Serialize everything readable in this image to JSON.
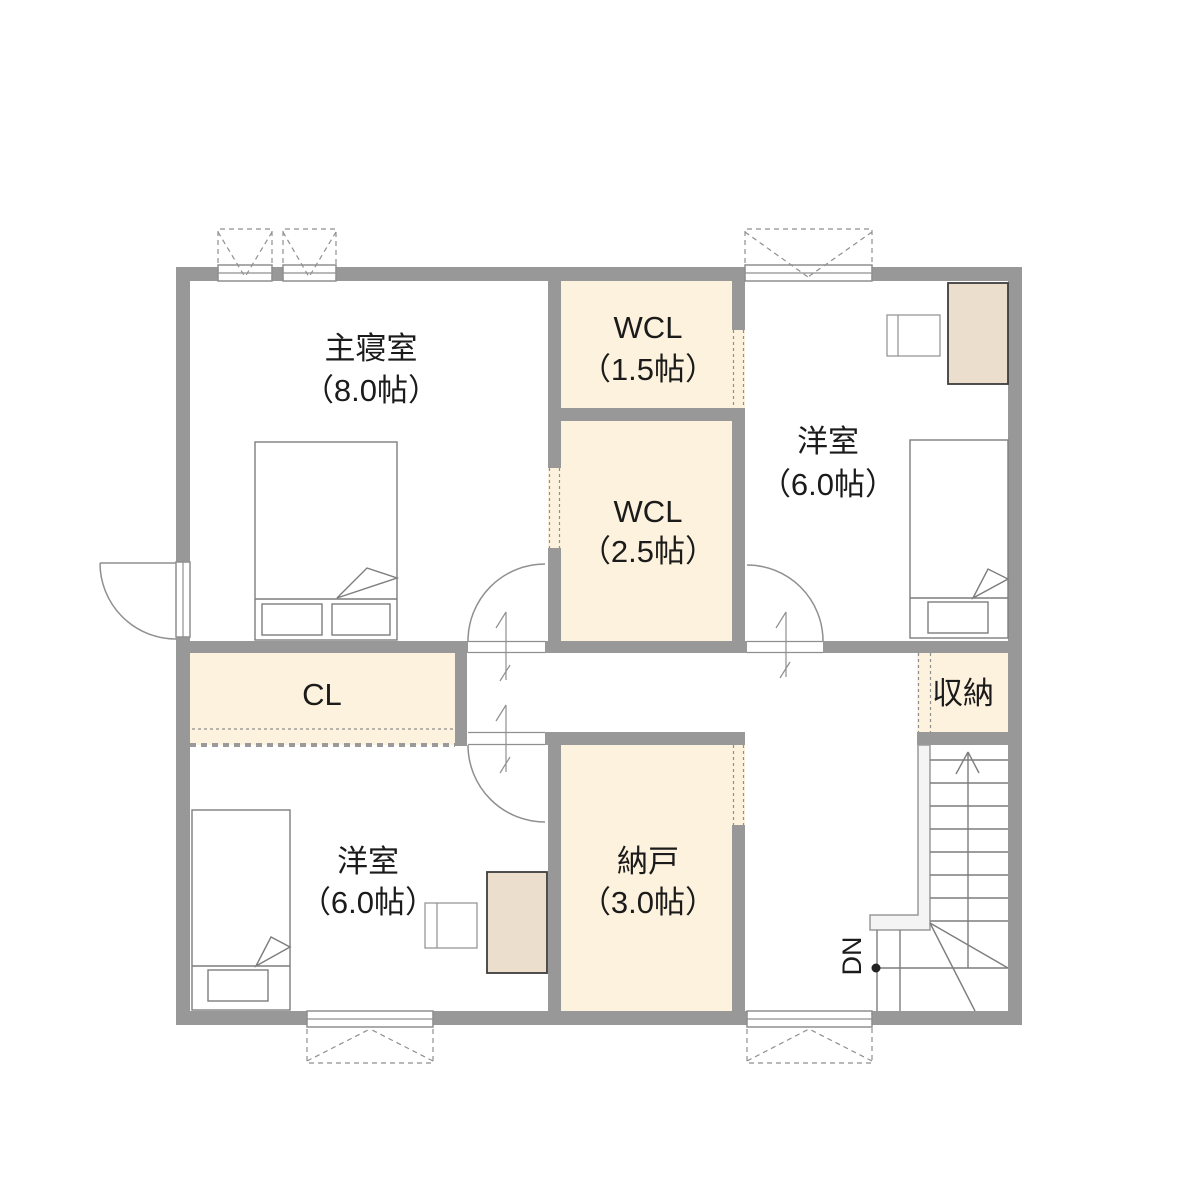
{
  "rooms": {
    "master_bedroom": {
      "name": "主寝室",
      "size": "（8.0帖）"
    },
    "wcl_small": {
      "name": "WCL",
      "size": "（1.5帖）"
    },
    "wcl_large": {
      "name": "WCL",
      "size": "（2.5帖）"
    },
    "bedroom_east": {
      "name": "洋室",
      "size": "（6.0帖）"
    },
    "closet": {
      "name": "CL"
    },
    "storage_shuno": {
      "name": "収納"
    },
    "bedroom_south": {
      "name": "洋室",
      "size": "（6.0帖）"
    },
    "storage_nando": {
      "name": "納戸",
      "size": "（3.0帖）"
    }
  },
  "stairs": {
    "label": "DN"
  },
  "colors": {
    "wall": "#989898",
    "room_fill": "#fdf2dd",
    "furniture_fill": "#ebdecd",
    "line": "#7d7d7d",
    "symbol": "#8f8f8f",
    "text": "#1b1b1b",
    "background": "#ffffff"
  }
}
